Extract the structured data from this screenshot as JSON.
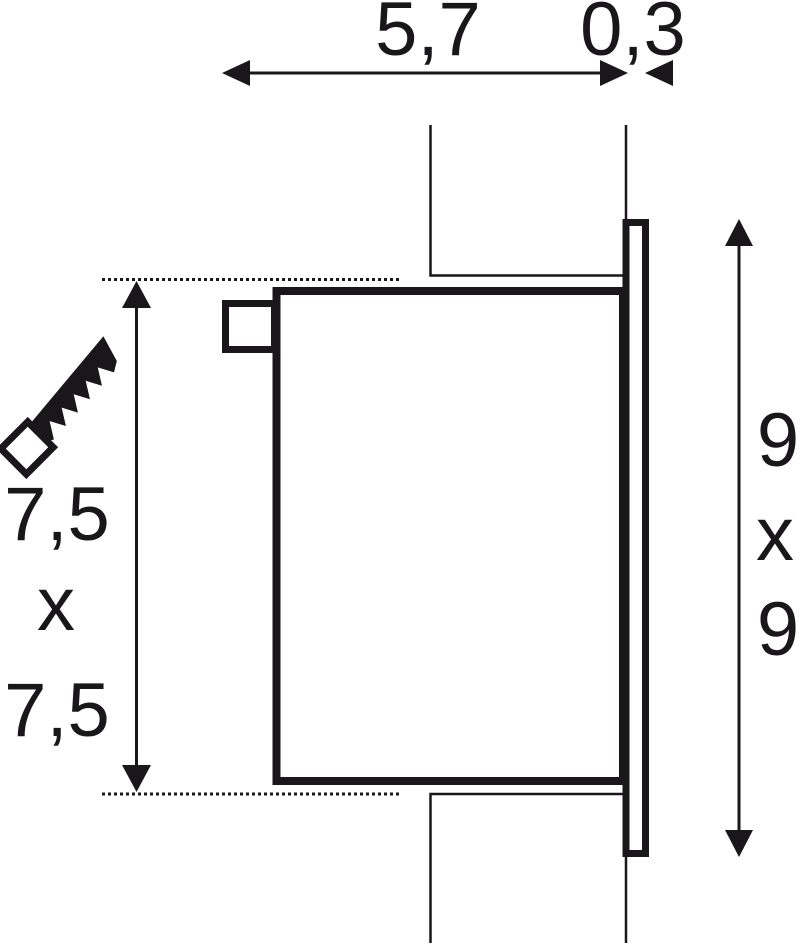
{
  "drawing": {
    "ink_color": "#1a171b",
    "top_dimension": {
      "depth": "5,7",
      "frame_thickness": "0,3"
    },
    "left_dimension": {
      "width": "7,5",
      "times": "x",
      "height": "7,5"
    },
    "right_dimension": {
      "width": "9",
      "times": "x",
      "height": "9"
    },
    "icons": [
      {
        "name": "saw-icon"
      }
    ]
  }
}
